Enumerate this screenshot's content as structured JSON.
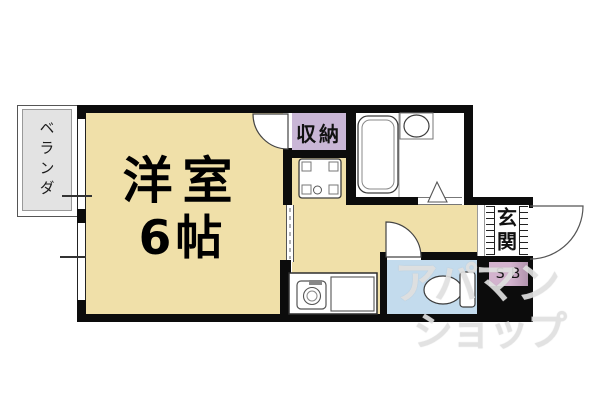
{
  "floorplan": {
    "rooms": {
      "main_room": {
        "name": "洋室",
        "size": "6帖"
      },
      "veranda": {
        "label": "ベランダ"
      },
      "closet": {
        "label": "収納"
      },
      "entrance": {
        "label": "玄関"
      },
      "shoe_box": {
        "label": "SB"
      }
    },
    "watermark": {
      "line1": "アパマン",
      "line2": "ショップ"
    },
    "fixtures": [
      "bathtub",
      "washbasin",
      "bath-folding-door-triangle",
      "washing-machine-pan",
      "stove-sink-unit",
      "kitchen-counter",
      "toilet",
      "door-swing-arc",
      "sliding-door"
    ],
    "colors": {
      "room_tan": "#f0e0a9",
      "closet_lavender": "#c9b6d6",
      "shoebox_purple": "#c9a9c4",
      "toilet_blue": "#c3dbed",
      "veranda_gray": "#e3e3e3",
      "wall_black": "#0c0c0c",
      "watermark_gray": "#e3e3e3"
    }
  }
}
